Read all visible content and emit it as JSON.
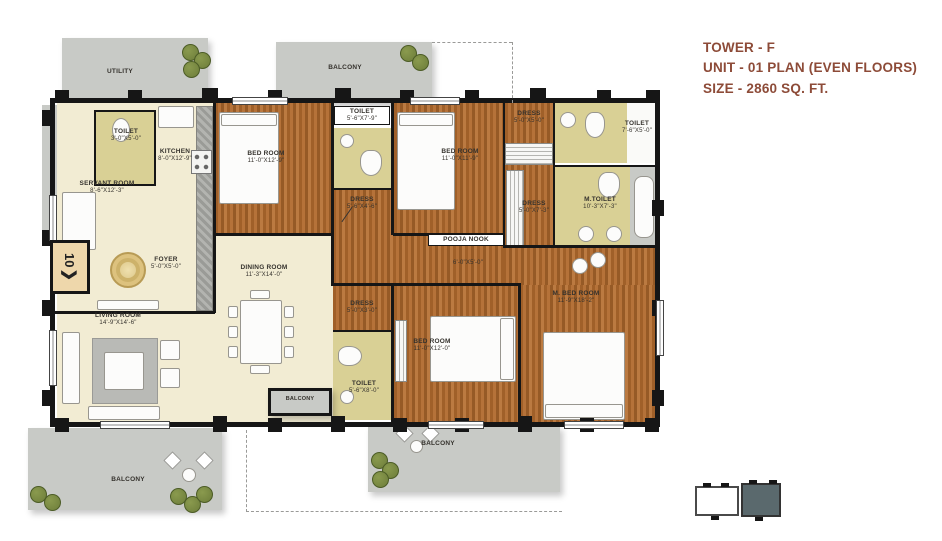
{
  "title": {
    "line1": "TOWER - F",
    "line2": "UNIT - 01 PLAN (EVEN FLOORS)",
    "line3": "SIZE - 2860 SQ. FT."
  },
  "colors": {
    "title": "#8d4b38",
    "wall": "#161616",
    "cream": "#f2ecd3",
    "khaki": "#d9d095",
    "gray": "#c8cac6",
    "tree": "#6d7d3a",
    "kpfill": "#5a696d"
  },
  "entry_marker": {
    "unit_number": "10",
    "arrow": "❯"
  },
  "rooms": {
    "utility": {
      "name": "UTILITY",
      "dims": ""
    },
    "toilet_kitchen": {
      "name": "TOILET",
      "dims": "3'-0\"X5'-0\""
    },
    "kitchen": {
      "name": "KITCHEN",
      "dims": "8'-0\"X12'-9\""
    },
    "servant_room": {
      "name": "SERVANT ROOM",
      "dims": "8'-6\"X12'-3\""
    },
    "bed_room_1": {
      "name": "BED ROOM",
      "dims": "11'-0\"X12'-9\""
    },
    "toilet_top": {
      "name": "TOILET",
      "dims": "5'-6\"X7'-9\""
    },
    "dress_bed_1": {
      "name": "DRESS",
      "dims": "5'-6\"X4'-6\""
    },
    "bed_room_2": {
      "name": "BED ROOM",
      "dims": "11'-0\"X11'-9\""
    },
    "dress_top": {
      "name": "DRESS",
      "dims": "5'-0\"X5'-0\""
    },
    "toilet_right": {
      "name": "TOILET",
      "dims": "7'-6\"X5'-0\""
    },
    "dress_master": {
      "name": "DRESS",
      "dims": "5'-0\"X7'-3\""
    },
    "m_toilet": {
      "name": "M.TOILET",
      "dims": "10'-3\"X7'-3\""
    },
    "pooja_nook": {
      "name": "POOJA NOOK",
      "dims": "6'-0\"X5'-0\""
    },
    "foyer": {
      "name": "FOYER",
      "dims": "5'-0\"X5'-0\""
    },
    "dining_room": {
      "name": "DINING ROOM",
      "dims": "11'-3\"X14'-0\""
    },
    "living_room": {
      "name": "LIVING ROOM",
      "dims": "14'-9\"X14'-6\""
    },
    "dress_bed_3": {
      "name": "DRESS",
      "dims": "5'-0\"X3'-0\""
    },
    "bed_room_3": {
      "name": "BED ROOM",
      "dims": "11'-0\"X12'-0\""
    },
    "toilet_bottom": {
      "name": "TOILET",
      "dims": "5'-6\"X8'-0\""
    },
    "m_bed_room": {
      "name": "M. BED ROOM",
      "dims": "11'-9\"X18'-2\""
    },
    "balcony_top": {
      "name": "BALCONY",
      "dims": ""
    },
    "balcony_inner": {
      "name": "BALCONY",
      "dims": ""
    },
    "balcony_bottom_left": {
      "name": "BALCONY",
      "dims": ""
    },
    "balcony_bottom_right": {
      "name": "BALCONY",
      "dims": ""
    }
  }
}
